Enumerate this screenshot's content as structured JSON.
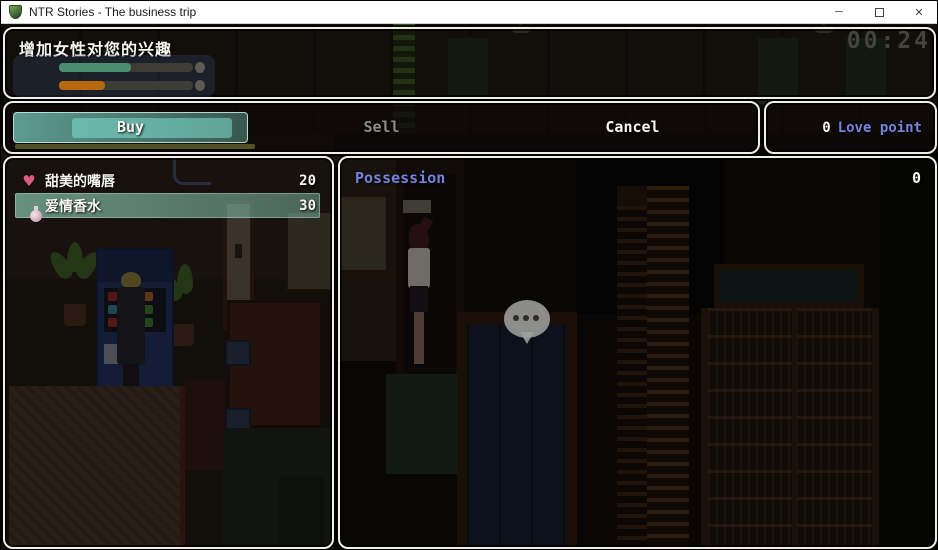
{
  "window": {
    "title": "NTR Stories - The business trip",
    "controls": {
      "minimize": "─",
      "maximize": "",
      "close": "✕"
    }
  },
  "help": {
    "text": "增加女性对您的兴趣"
  },
  "timer": {
    "value": "00:24"
  },
  "gauges": [
    {
      "name": "affection-gauge",
      "fill_percent": 54,
      "color": "#4c8e70"
    },
    {
      "name": "arousal-gauge",
      "fill_percent": 34,
      "color": "#b5680d"
    }
  ],
  "shop_commands": {
    "buy": {
      "label": "Buy",
      "selected": true,
      "enabled": true
    },
    "sell": {
      "label": "Sell",
      "selected": false,
      "enabled": false
    },
    "cancel": {
      "label": "Cancel",
      "selected": false,
      "enabled": true
    }
  },
  "currency": {
    "amount": "0",
    "unit": "Love point"
  },
  "items": [
    {
      "icon": "heart-icon",
      "name": "甜美的嘴唇",
      "price": "20",
      "selected": false
    },
    {
      "icon": "perfume-bottle-icon",
      "name": "爱情香水",
      "price": "30",
      "selected": true
    }
  ],
  "possession": {
    "label": "Possession",
    "value": "0"
  },
  "colors": {
    "system_blue": "#7585dd",
    "selection_teal": "#8ccdb6",
    "window_border": "#efefe6",
    "disabled_text": "#8d8d87",
    "timer_gray": "#454340"
  }
}
